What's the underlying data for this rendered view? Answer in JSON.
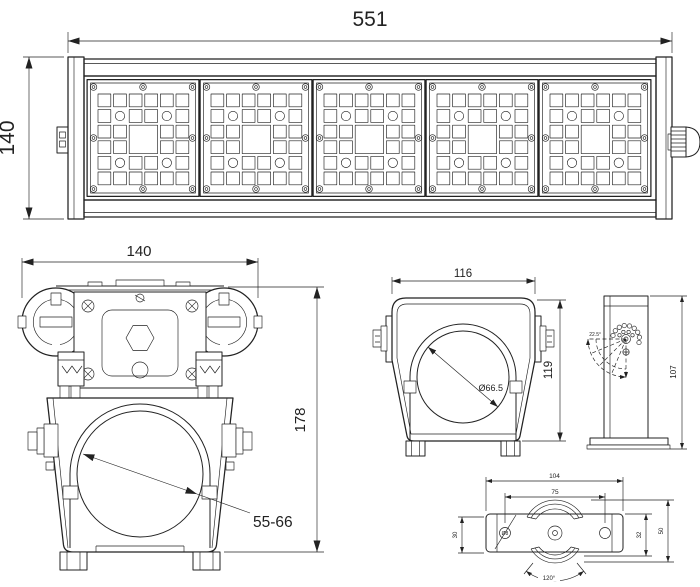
{
  "colors": {
    "line": "#222222",
    "background": "#ffffff"
  },
  "views": {
    "front": {
      "width_dim": "551",
      "height_dim": "140"
    },
    "end": {
      "width_dim": "140",
      "height_dim": "178",
      "pipe_range_dim": "55-66"
    },
    "bracket": {
      "width_dim": "116",
      "height_dim": "119",
      "diameter_dim": "Ø66.5"
    },
    "pole": {
      "height_dim": "107",
      "angle_step_dim": "22.5°"
    },
    "plate": {
      "width_dim": "104",
      "hole_pitch_dim": "75",
      "end_height_dim": "30",
      "body_height_dim": "32",
      "overall_height_dim": "50",
      "hole_diameter_dim": "Ø8",
      "slot_angle_dim": "120°"
    }
  }
}
